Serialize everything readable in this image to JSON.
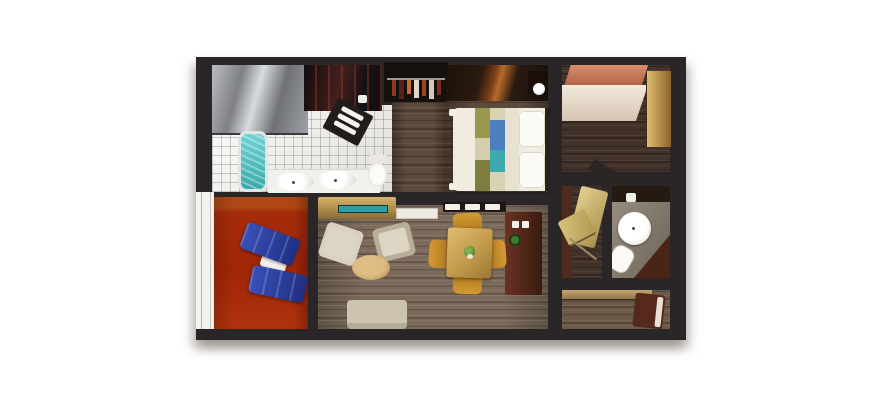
{
  "figure": {
    "type": "floor-plan",
    "title": "Two-bedroom suite with balcony — top-down 3D floor plan",
    "background": "#ffffff",
    "wall_color": "#2a2628"
  },
  "palette": {
    "wall": "#2a2628",
    "wood_dark": "#5d4a3b",
    "wood_grey": "#7c6a5a",
    "tile": "#eceae5",
    "tub_water": "#4fc0c2",
    "balcony_floor": "#cd6a33",
    "balcony_band": "#d9a868",
    "lounger_blue": "#2c3f9f",
    "bed_linen": "#f0ece0",
    "runner_olive": "#98994f",
    "runner_blue": "#4d7fbe",
    "runner_teal": "#3fa9ad",
    "runner_cream": "#d5cfae",
    "armchair_beige": "#d9d2c0",
    "ottoman_tan": "#c9a96a",
    "sofa_beige": "#cdc4b0",
    "dining_wood": "#d1a858",
    "chair_gold": "#c8922e",
    "bar_mahogany": "#5c2c1d",
    "tv_screen": "#2aa0a8",
    "console_tan": "#c09a50",
    "wardrobe_tan": "#cfa95e",
    "ceiling_salmon": "#c97f5e",
    "chaise_gold": "#cdb873",
    "plant_green": "#3f7a2e"
  },
  "rooms": {
    "master_bathroom": {
      "label": "Master bathroom",
      "items": [
        "shower",
        "bathtub",
        "double-sink counter",
        "toilet",
        "towel shelf",
        "tile floor"
      ]
    },
    "closet": {
      "label": "Closet",
      "items": [
        "hanging clothes",
        "clothes rod"
      ]
    },
    "master_bedroom": {
      "label": "Master bedroom",
      "items": [
        "queen bed",
        "two pillows",
        "striped bed runner",
        "wardrobe",
        "nightstand",
        "lamp"
      ]
    },
    "second_bedroom": {
      "label": "Second bedroom",
      "items": [
        "bed",
        "tall wardrobe",
        "entry ceiling"
      ]
    },
    "second_bathroom": {
      "label": "Second bathroom",
      "items": [
        "round basin",
        "toilet",
        "vanity wedge",
        "cup"
      ]
    },
    "chaise_nook": {
      "label": "Chaise nook",
      "items": [
        "gold chaise cushions"
      ]
    },
    "living_room": {
      "label": "Living and dining room",
      "items": [
        "tv console",
        "tv screen",
        "white shelf",
        "tray counter",
        "bar cabinet",
        "armchair",
        "armchair",
        "oval ottoman",
        "sofa",
        "dining table",
        "four gold chairs",
        "plant centerpiece"
      ]
    },
    "study": {
      "label": "Study nook",
      "items": [
        "desk shelf",
        "chair with cushion"
      ]
    },
    "balcony": {
      "label": "Balcony",
      "items": [
        "railing",
        "lounge chair",
        "lounge chair",
        "side table"
      ]
    }
  }
}
